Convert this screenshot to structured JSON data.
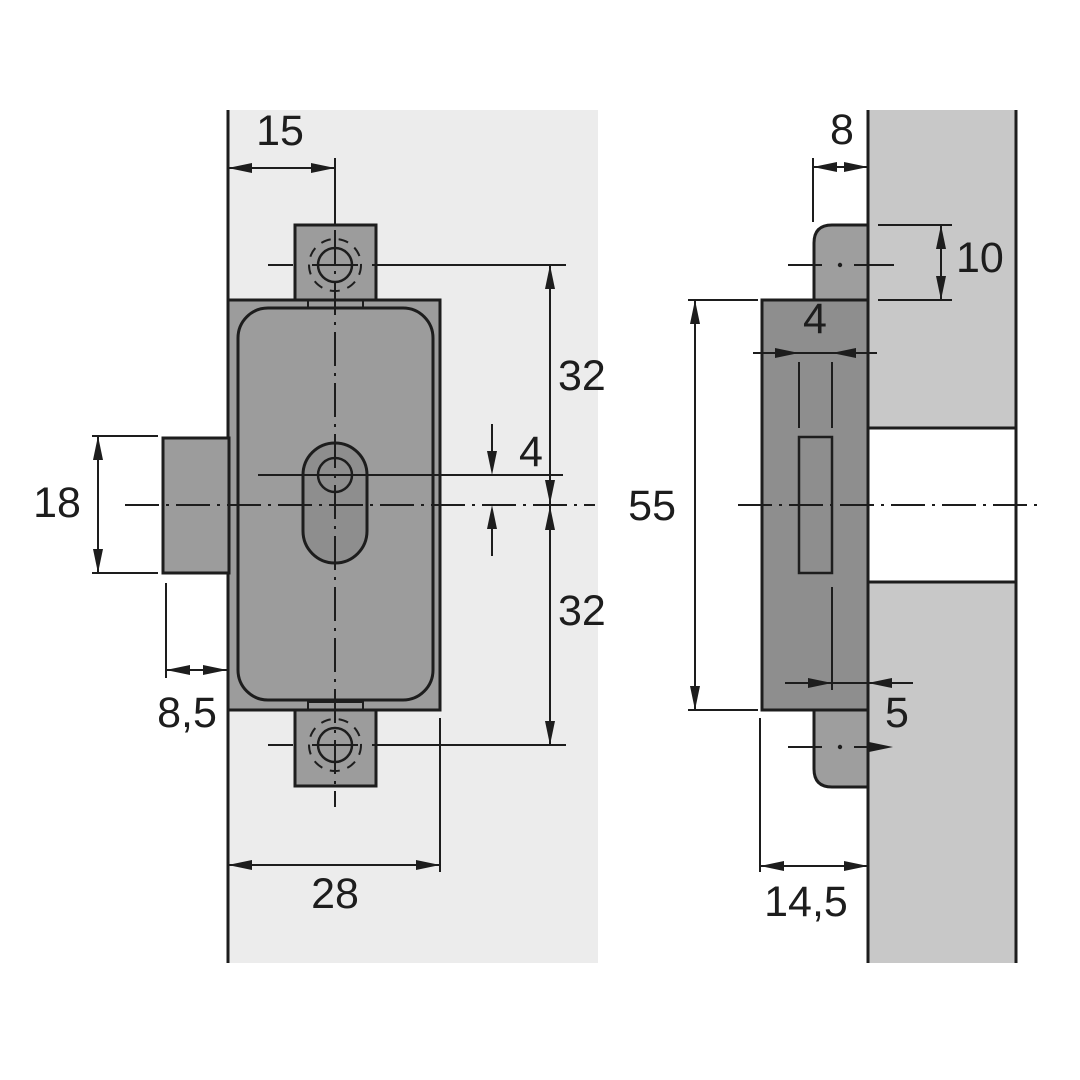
{
  "colors": {
    "line": "#1d1d1d",
    "metal_front": "#9c9c9c",
    "metal_dark": "#8e8e8e",
    "tab_side": "#9e9e9e",
    "panel_front": "#ececec",
    "panel_section": "#c8c8c8",
    "hole_fill": "#ffffff"
  },
  "front_view": {
    "dims": {
      "edge_to_hole_axis": "15",
      "hole_to_centerline_top": "32",
      "keyhole_offset": "4",
      "centerline_to_hole_bottom": "32",
      "bolt_height": "18",
      "bolt_protrusion": "8,5",
      "housing_width": "28"
    }
  },
  "side_view": {
    "dims": {
      "tab_depth": "8",
      "tab_height": "10",
      "slot_width": "4",
      "housing_height": "55",
      "slot_to_front": "5",
      "housing_depth": "14,5"
    }
  }
}
